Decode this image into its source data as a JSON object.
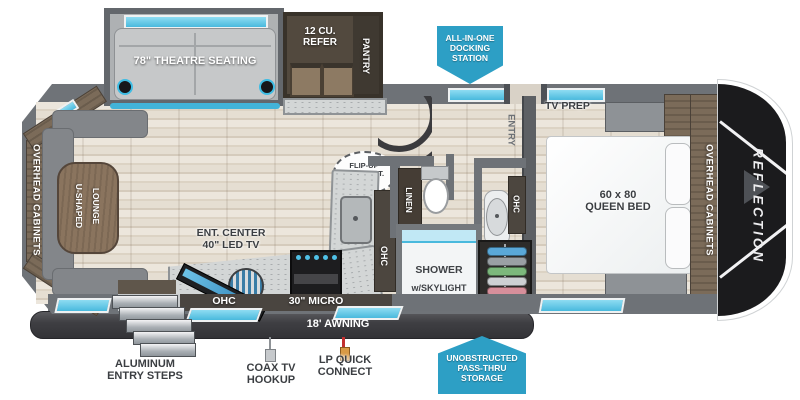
{
  "badges": {
    "docking": {
      "line1": "ALL-IN-ONE",
      "line2": "DOCKING",
      "line3": "STATION"
    },
    "passthru": {
      "line1": "UNOBSTRUCTED",
      "line2": "PASS-THRU",
      "line3": "STORAGE"
    }
  },
  "living": {
    "theatre_seating": "78\" THEATRE SEATING",
    "overhead_cabinets": "OVERHEAD CABINETS",
    "lounge_line1": "U-SHAPED",
    "lounge_line2": "LOUNGE",
    "ent_center_line1": "ENT. CENTER",
    "ent_center_line2": "40\" LED TV",
    "ohc": "OHC"
  },
  "kitchen": {
    "refer_line1": "12 CU.",
    "refer_line2": "REFER",
    "pantry": "PANTRY",
    "flip_line1": "FLIP-UP",
    "flip_line2": "C'TOP EXT.",
    "ohc": "OHC",
    "micro": "30\" MICRO"
  },
  "bath": {
    "linen": "LINEN",
    "ohc": "OHC",
    "shower_line1": "SHOWER",
    "shower_line2": "w/SKYLIGHT"
  },
  "bedroom": {
    "entry": "ENTRY",
    "tv_prep": "TV PREP",
    "bed_line1": "60 x 80",
    "bed_line2": "QUEEN BED",
    "overhead_cabinets": "OVERHEAD CABINETS"
  },
  "exterior": {
    "brand": "REFLECTION",
    "awning": "18' AWNING",
    "steps_line1": "ALUMINUM",
    "steps_line2": "ENTRY STEPS",
    "coax_line1": "COAX TV",
    "coax_line2": "HOOKUP",
    "lp_line1": "LP QUICK",
    "lp_line2": "CONNECT"
  },
  "colors": {
    "accent_blue": "#49b9dd",
    "badge_blue": "#2d9fc5"
  }
}
